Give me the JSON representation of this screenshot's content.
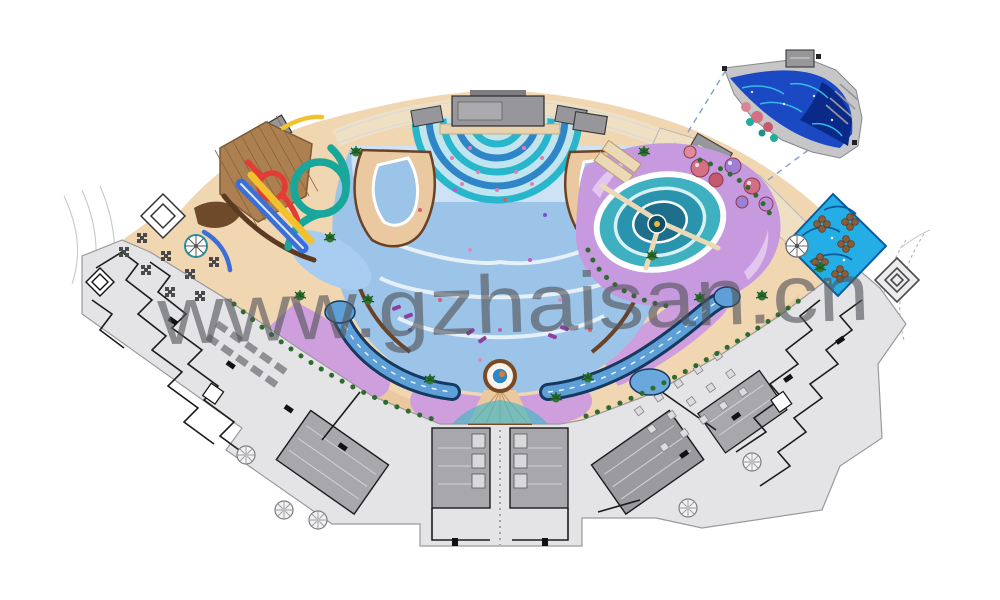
{
  "watermark": {
    "text": "www.gzhaisan.cn",
    "color": "#54555a"
  },
  "palette": {
    "page_bg": "#ffffff",
    "sand": "#f1d6b2",
    "sand_deep": "#eac9a0",
    "deck_wood": "#ad8051",
    "pool_blue": "#9cc3e8",
    "pool_pale": "#d6e7f6",
    "river_blue": "#5e9fd8",
    "river_outline": "#16395f",
    "wave_teal": "#27b6cc",
    "wave_blue": "#2e86c8",
    "lagoon_cyan": "#25aee6",
    "path_purple": "#cf9fdd",
    "ride_purple": "#c79ae0",
    "slide_red": "#e23c34",
    "slide_yellow": "#f2c12e",
    "slide_blue": "#3a6fd8",
    "slide_teal": "#19a79b",
    "building_gray": "#e4e4e6",
    "room_gray": "#a8a8ac",
    "roof_gray": "#97979b",
    "wall_black": "#1c1c1c",
    "callout_blue": "#1b49c4",
    "callout_blue_deep": "#0a2a8a",
    "foliage_green": "#2f7a33"
  }
}
